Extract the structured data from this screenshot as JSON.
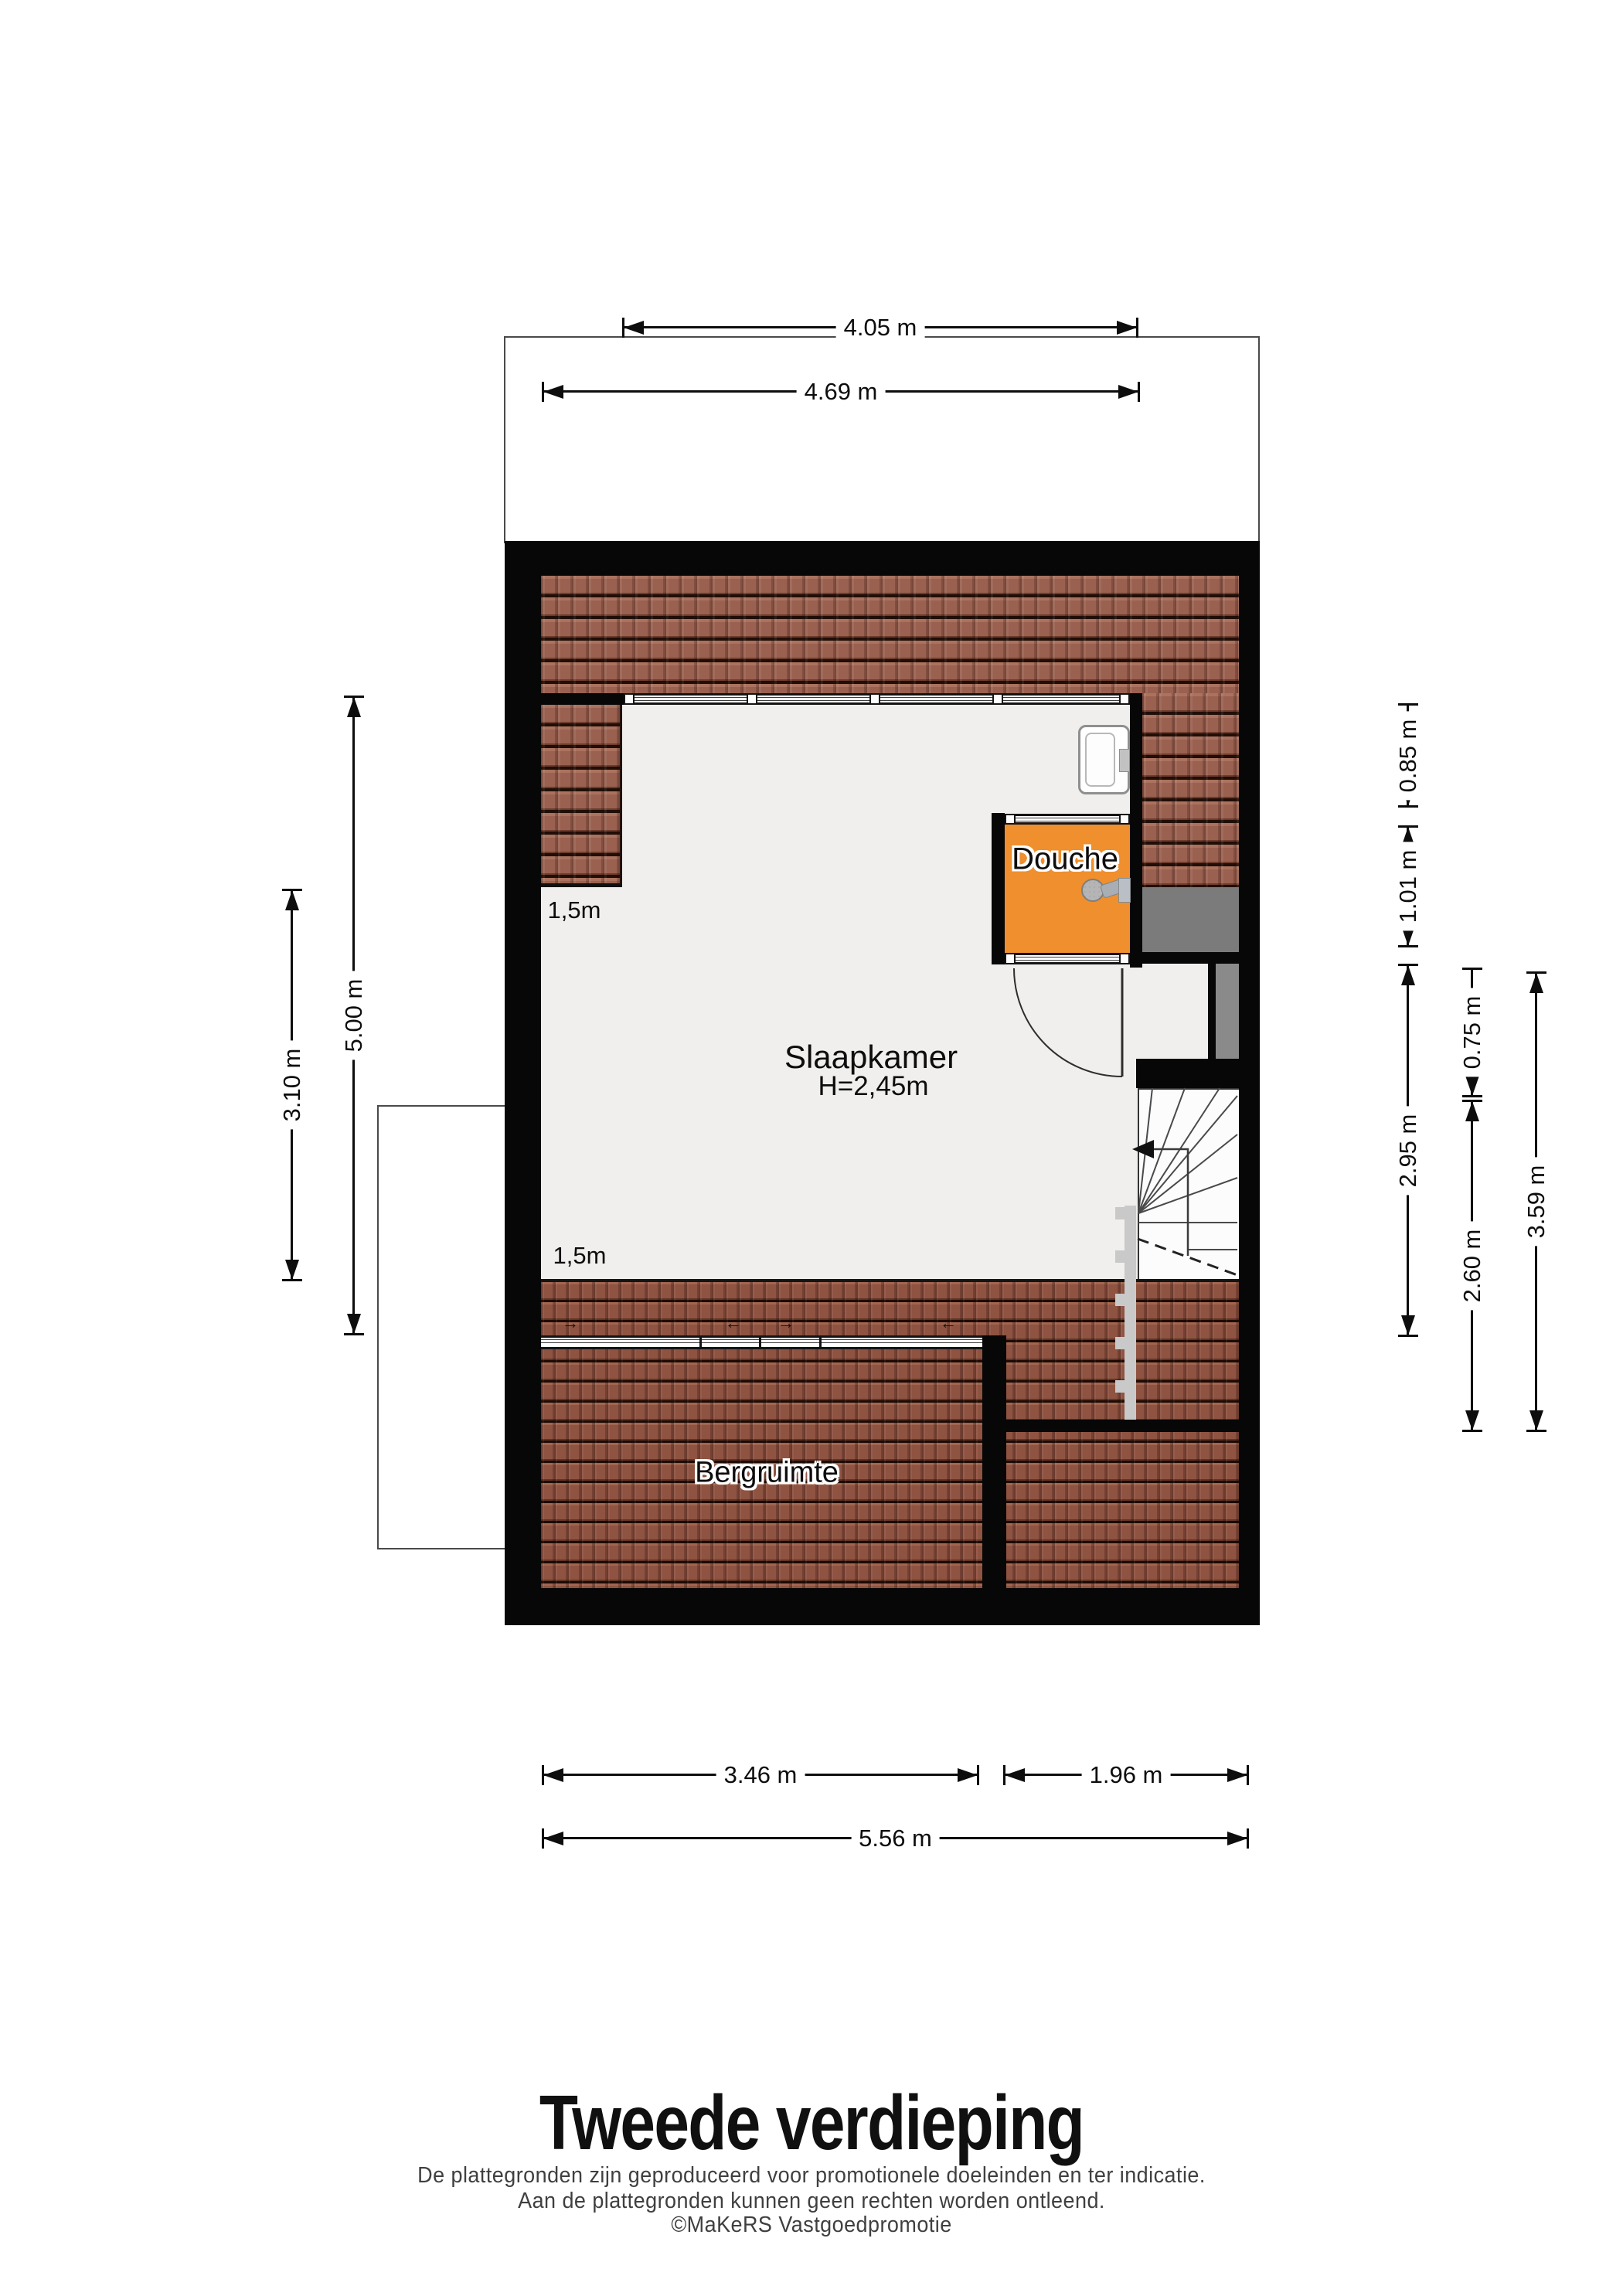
{
  "title": {
    "text": "Tweede verdieping"
  },
  "footer": {
    "line1": "De plattegronden zijn geproduceerd voor promotionele doeleinden en ter indicatie.",
    "line2": "Aan de plattegronden kunnen geen rechten worden ontleend.",
    "line3": "©MaKeRS Vastgoedpromotie"
  },
  "rooms": {
    "bedroom": {
      "name": "Slaapkamer",
      "ceiling": "H=2,45m"
    },
    "shower": {
      "name": "Douche"
    },
    "storage": {
      "name": "Bergruimte"
    }
  },
  "knee_walls": {
    "upper": "1,5m",
    "lower": "1,5m"
  },
  "dimensions": {
    "top_outer": "4.05 m",
    "top_inner": "4.69 m",
    "left_outer": "5.00 m",
    "left_inner": "3.10 m",
    "right_a": "0.85 m",
    "right_b": "1.01 m",
    "right_c": "2.95 m",
    "right_d": "0.75 m",
    "right_e": "2.60 m",
    "right_f": "3.59 m",
    "bottom_left": "3.46 m",
    "bottom_right": "1.96 m",
    "bottom_total": "5.56 m"
  },
  "markers": {
    "vent_right": "→",
    "vent_left": "←"
  },
  "colors": {
    "wall": "#070707",
    "floor": "#f0efed",
    "roof_tile": "#9a6150",
    "shower_floor": "#ef8f2d",
    "void_gray": "#7b7b7b",
    "duct_gray": "#8a8a8a",
    "step_marker": "#c9c9c9"
  }
}
